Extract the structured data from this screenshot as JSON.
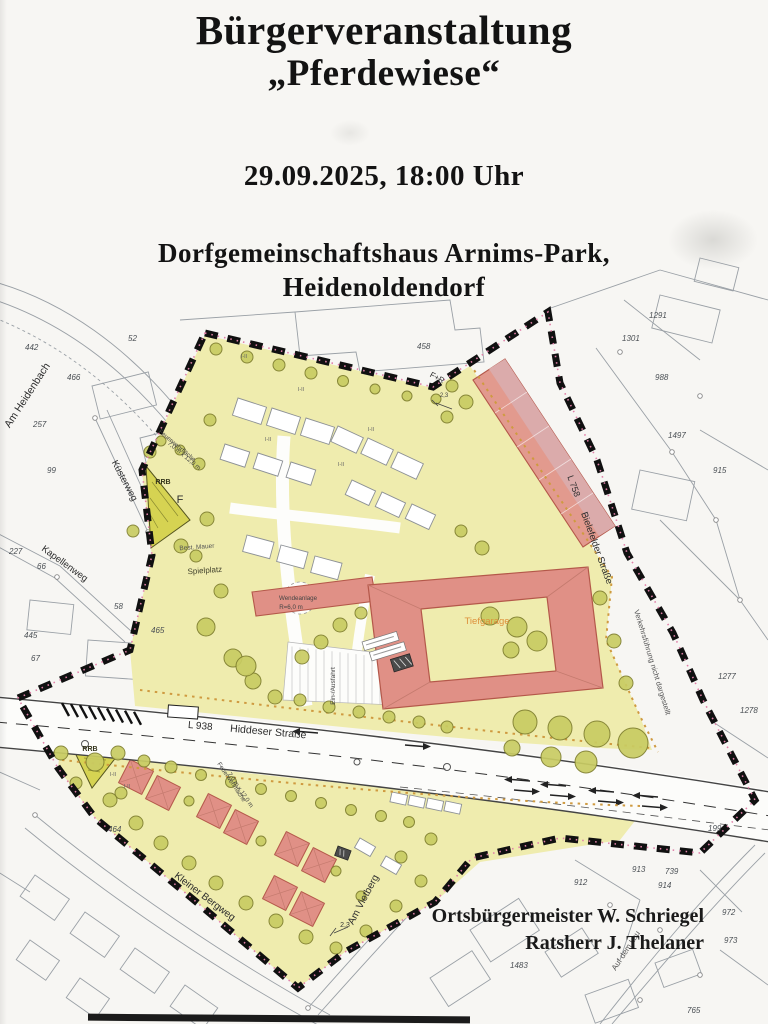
{
  "header": {
    "title_line1": "Bürgerveranstaltung",
    "title_line2": "„Pferdewiese“",
    "datetime": "29.09.2025, 18:00 Uhr",
    "venue_line1": "Dorfgemeinschaftshaus Arnims-Park,",
    "venue_line2": "Heidenoldendorf"
  },
  "signature": {
    "line1": "Ortsbürgermeister W. Schriegel",
    "line2": "Ratsherr J. Thelaner"
  },
  "map": {
    "labels": [
      "Am Heidenbach",
      "Küsterweg",
      "Kapellenweg",
      "L 938",
      "Hiddeser Straße",
      "L 758",
      "Bielefelder Straße",
      "Verkehrsführung nicht dargestellt",
      "Kleiner Bergweg",
      "Am Vietberg",
      "Auf dem Lau",
      "F+R",
      "RRB",
      "RRB",
      "F",
      "Spielplatz",
      "Best. Mauer",
      "Wendeanlage",
      "R=6,0 m",
      "Feuerwehrfläche",
      "7,0 m x 12,0 m",
      "Feuerwehrfläche",
      "7,0 m x 12,0 m",
      "Tiefgarage",
      "Ein-/Ausfahrt",
      "I-II",
      "I-II",
      "I-II",
      "I-II",
      "I-II",
      "I-II",
      "I-II",
      "2,3",
      "2,3"
    ],
    "parcel_numbers": [
      "442",
      "466",
      "257",
      "99",
      "52",
      "458",
      "1291",
      "1301",
      "988",
      "1497",
      "915",
      "1277",
      "1278",
      "227",
      "66",
      "58",
      "445",
      "67",
      "465",
      "464",
      "199",
      "913",
      "739",
      "914",
      "912",
      "972",
      "973",
      "765",
      "1483"
    ],
    "colors": {
      "plan_area_yellow": "#efecae",
      "building_red": "#e09086",
      "building_red_light": "#dbabab",
      "tree_olive": "#c9cc63",
      "boundary_black": "#111111",
      "dotted_accent": "#cf9a40",
      "rrb_green": "#d6d352",
      "tiefgarage_text": "#dd8f3a"
    }
  }
}
